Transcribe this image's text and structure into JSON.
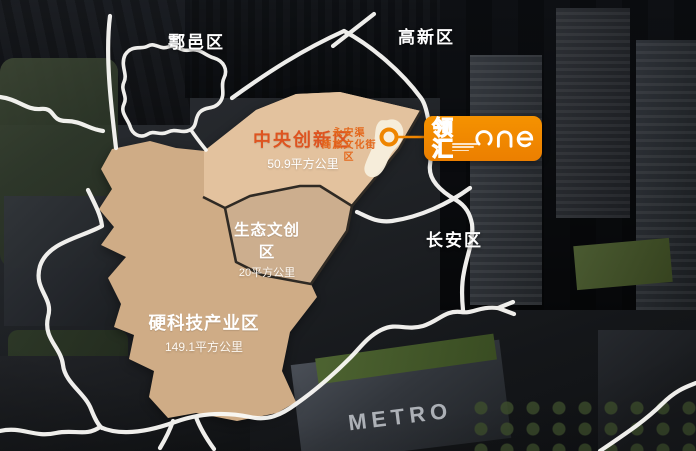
{
  "canvas": {
    "width": 696,
    "height": 451
  },
  "colors": {
    "accent_orange": "#ef8500",
    "district_name_orange": "#de5420",
    "poi_text_orange": "#e4681c",
    "district_hardtech_fill": "#cfac86",
    "district_central_fill": "#e3c29e",
    "district_eco_fill": "#ccae8e",
    "road_white": "#fbfaf7",
    "border_dark": "#2f2a24",
    "canal_fill": "#f7eedd"
  },
  "region_labels": {
    "huyi": "鄠邑区",
    "gaoxin": "高新区",
    "changan": "长安区"
  },
  "districts": {
    "central": {
      "name": "中央创新区",
      "area": "50.9平方公里"
    },
    "eco": {
      "name": "生态文创区",
      "area": "20平方公里"
    },
    "hardtech": {
      "name": "硬科技产业区",
      "area": "149.1平方公里"
    }
  },
  "poi": {
    "line1": "永安渠",
    "line2": "商旅文化街区"
  },
  "logo": {
    "cn": "领汇",
    "en": "one"
  },
  "photo": {
    "metro": "METRO"
  }
}
